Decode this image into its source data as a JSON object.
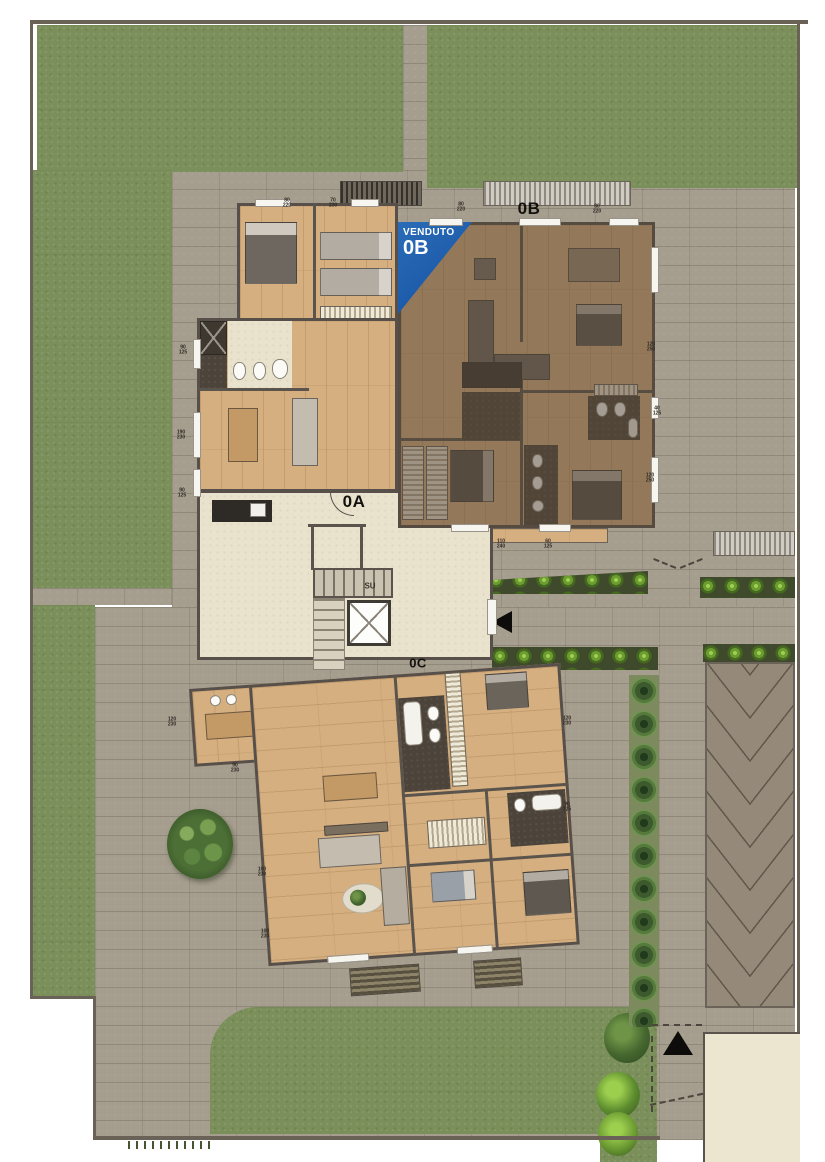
{
  "plan": {
    "banner": {
      "sold_label": "VENDUTO",
      "unit_label": "0B",
      "color": "#1e5dab"
    },
    "stairs_label": "SU",
    "unit_labels": [
      {
        "id": "0A",
        "label": "0A",
        "x": 354,
        "y": 502,
        "size": 17
      },
      {
        "id": "0B",
        "label": "0B",
        "x": 529,
        "y": 209,
        "size": 17
      },
      {
        "id": "0C",
        "label": "0C",
        "x": 418,
        "y": 663,
        "size": 13
      }
    ],
    "dimension_labels": [
      {
        "text": "80/220",
        "x": 287,
        "y": 203
      },
      {
        "text": "70/230",
        "x": 333,
        "y": 203
      },
      {
        "text": "80/220",
        "x": 461,
        "y": 207
      },
      {
        "text": "80/220",
        "x": 597,
        "y": 209
      },
      {
        "text": "90/125",
        "x": 183,
        "y": 350
      },
      {
        "text": "190/230",
        "x": 181,
        "y": 435
      },
      {
        "text": "90/125",
        "x": 182,
        "y": 493
      },
      {
        "text": "120/250",
        "x": 651,
        "y": 347
      },
      {
        "text": "40/125",
        "x": 657,
        "y": 411
      },
      {
        "text": "120/250",
        "x": 650,
        "y": 478
      },
      {
        "text": "110/240",
        "x": 501,
        "y": 544
      },
      {
        "text": "60/125",
        "x": 548,
        "y": 544
      },
      {
        "text": "120/230",
        "x": 172,
        "y": 722
      },
      {
        "text": "90/230",
        "x": 235,
        "y": 768
      },
      {
        "text": "100/230",
        "x": 262,
        "y": 872
      },
      {
        "text": "100/230",
        "x": 265,
        "y": 934
      },
      {
        "text": "120/230",
        "x": 567,
        "y": 721
      },
      {
        "text": "90/125",
        "x": 567,
        "y": 807
      }
    ],
    "colors": {
      "sold_banner": "#1e5dab",
      "grass": "#7b8f5b",
      "paving": "#a59d8d",
      "wood_floor": "#d5af80",
      "walls": "#57504a",
      "lobby": "#e9e2cc",
      "hedge": "#3c5830",
      "plants": "#79af3e",
      "driveway": "#95897a",
      "neighbor_slab": "#ece5cf"
    }
  }
}
